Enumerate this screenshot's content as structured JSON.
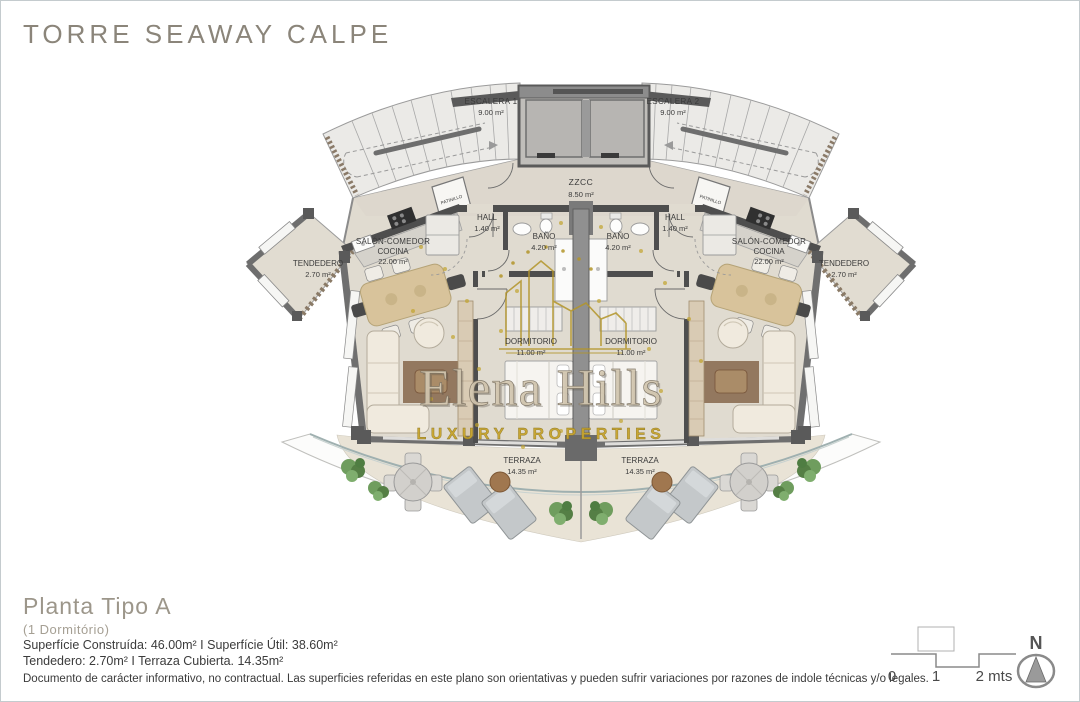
{
  "page_title": "TORRE SEAWAY CALPE",
  "watermark": {
    "brand": "Elena Hills",
    "tagline": "LUXURY PROPERTIES"
  },
  "plan": {
    "rooms": {
      "escalera1": {
        "name": "ESCALERA 1",
        "area": "9.00 m²"
      },
      "escalera2": {
        "name": "ESCALERA 2",
        "area": "9.00 m²"
      },
      "zzcc": {
        "name": "ZZCC",
        "area": "8.50 m²"
      },
      "patinillo_left": {
        "name": "PATINILLO"
      },
      "patinillo_right": {
        "name": "PATINILLO"
      },
      "hall_left": {
        "name": "HALL",
        "area": "1.40 m²"
      },
      "hall_right": {
        "name": "HALL",
        "area": "1.40 m²"
      },
      "bano_left": {
        "name": "BAÑO",
        "area": "4.20 m²"
      },
      "bano_right": {
        "name": "BAÑO",
        "area": "4.20 m²"
      },
      "salon_left": {
        "line1": "SALÓN-COMEDOR",
        "line2": "COCINA",
        "area": "22.00 m²"
      },
      "salon_right": {
        "line1": "SALÓN-COMEDOR",
        "line2": "COCINA",
        "area": "22.00 m²"
      },
      "dormitorio_left": {
        "name": "DORMITORIO",
        "area": "11.00 m²"
      },
      "dormitorio_right": {
        "name": "DORMITORIO",
        "area": "11.00 m²"
      },
      "tendedero_left": {
        "name": "TENDEDERO",
        "area": "2.70 m²"
      },
      "tendedero_right": {
        "name": "TENDEDERO",
        "area": "2.70 m²"
      },
      "terraza_left": {
        "name": "TERRAZA",
        "area": "14.35 m²"
      },
      "terraza_right": {
        "name": "TERRAZA",
        "area": "14.35 m²"
      }
    }
  },
  "footer": {
    "plan_title": "Planta Tipo A",
    "plan_subtitle": "(1 Dormitório)",
    "surface_line1": "Superfície Construída: 46.00m² I Superfície Útil: 38.60m²",
    "surface_line2": "Tendedero: 2.70m² I Terraza Cubierta. 14.35m²",
    "disclaimer": "Documento de carácter informativo, no contractual. Las superficies referidas en este plano son orientativas y pueden sufrir variaciones por razones de indole técnicas y/o legales."
  },
  "scale_bar": {
    "label_0": "0",
    "label_1": "1",
    "label_2": "2 mts"
  },
  "compass": {
    "north_label": "N"
  },
  "colors": {
    "accent_gold": "#c3a233",
    "wall_dark": "#4f4f4f",
    "floor_beige": "#e1dcd1",
    "terrace_beige": "#e9e3d6",
    "title_gray": "#8b857a"
  }
}
